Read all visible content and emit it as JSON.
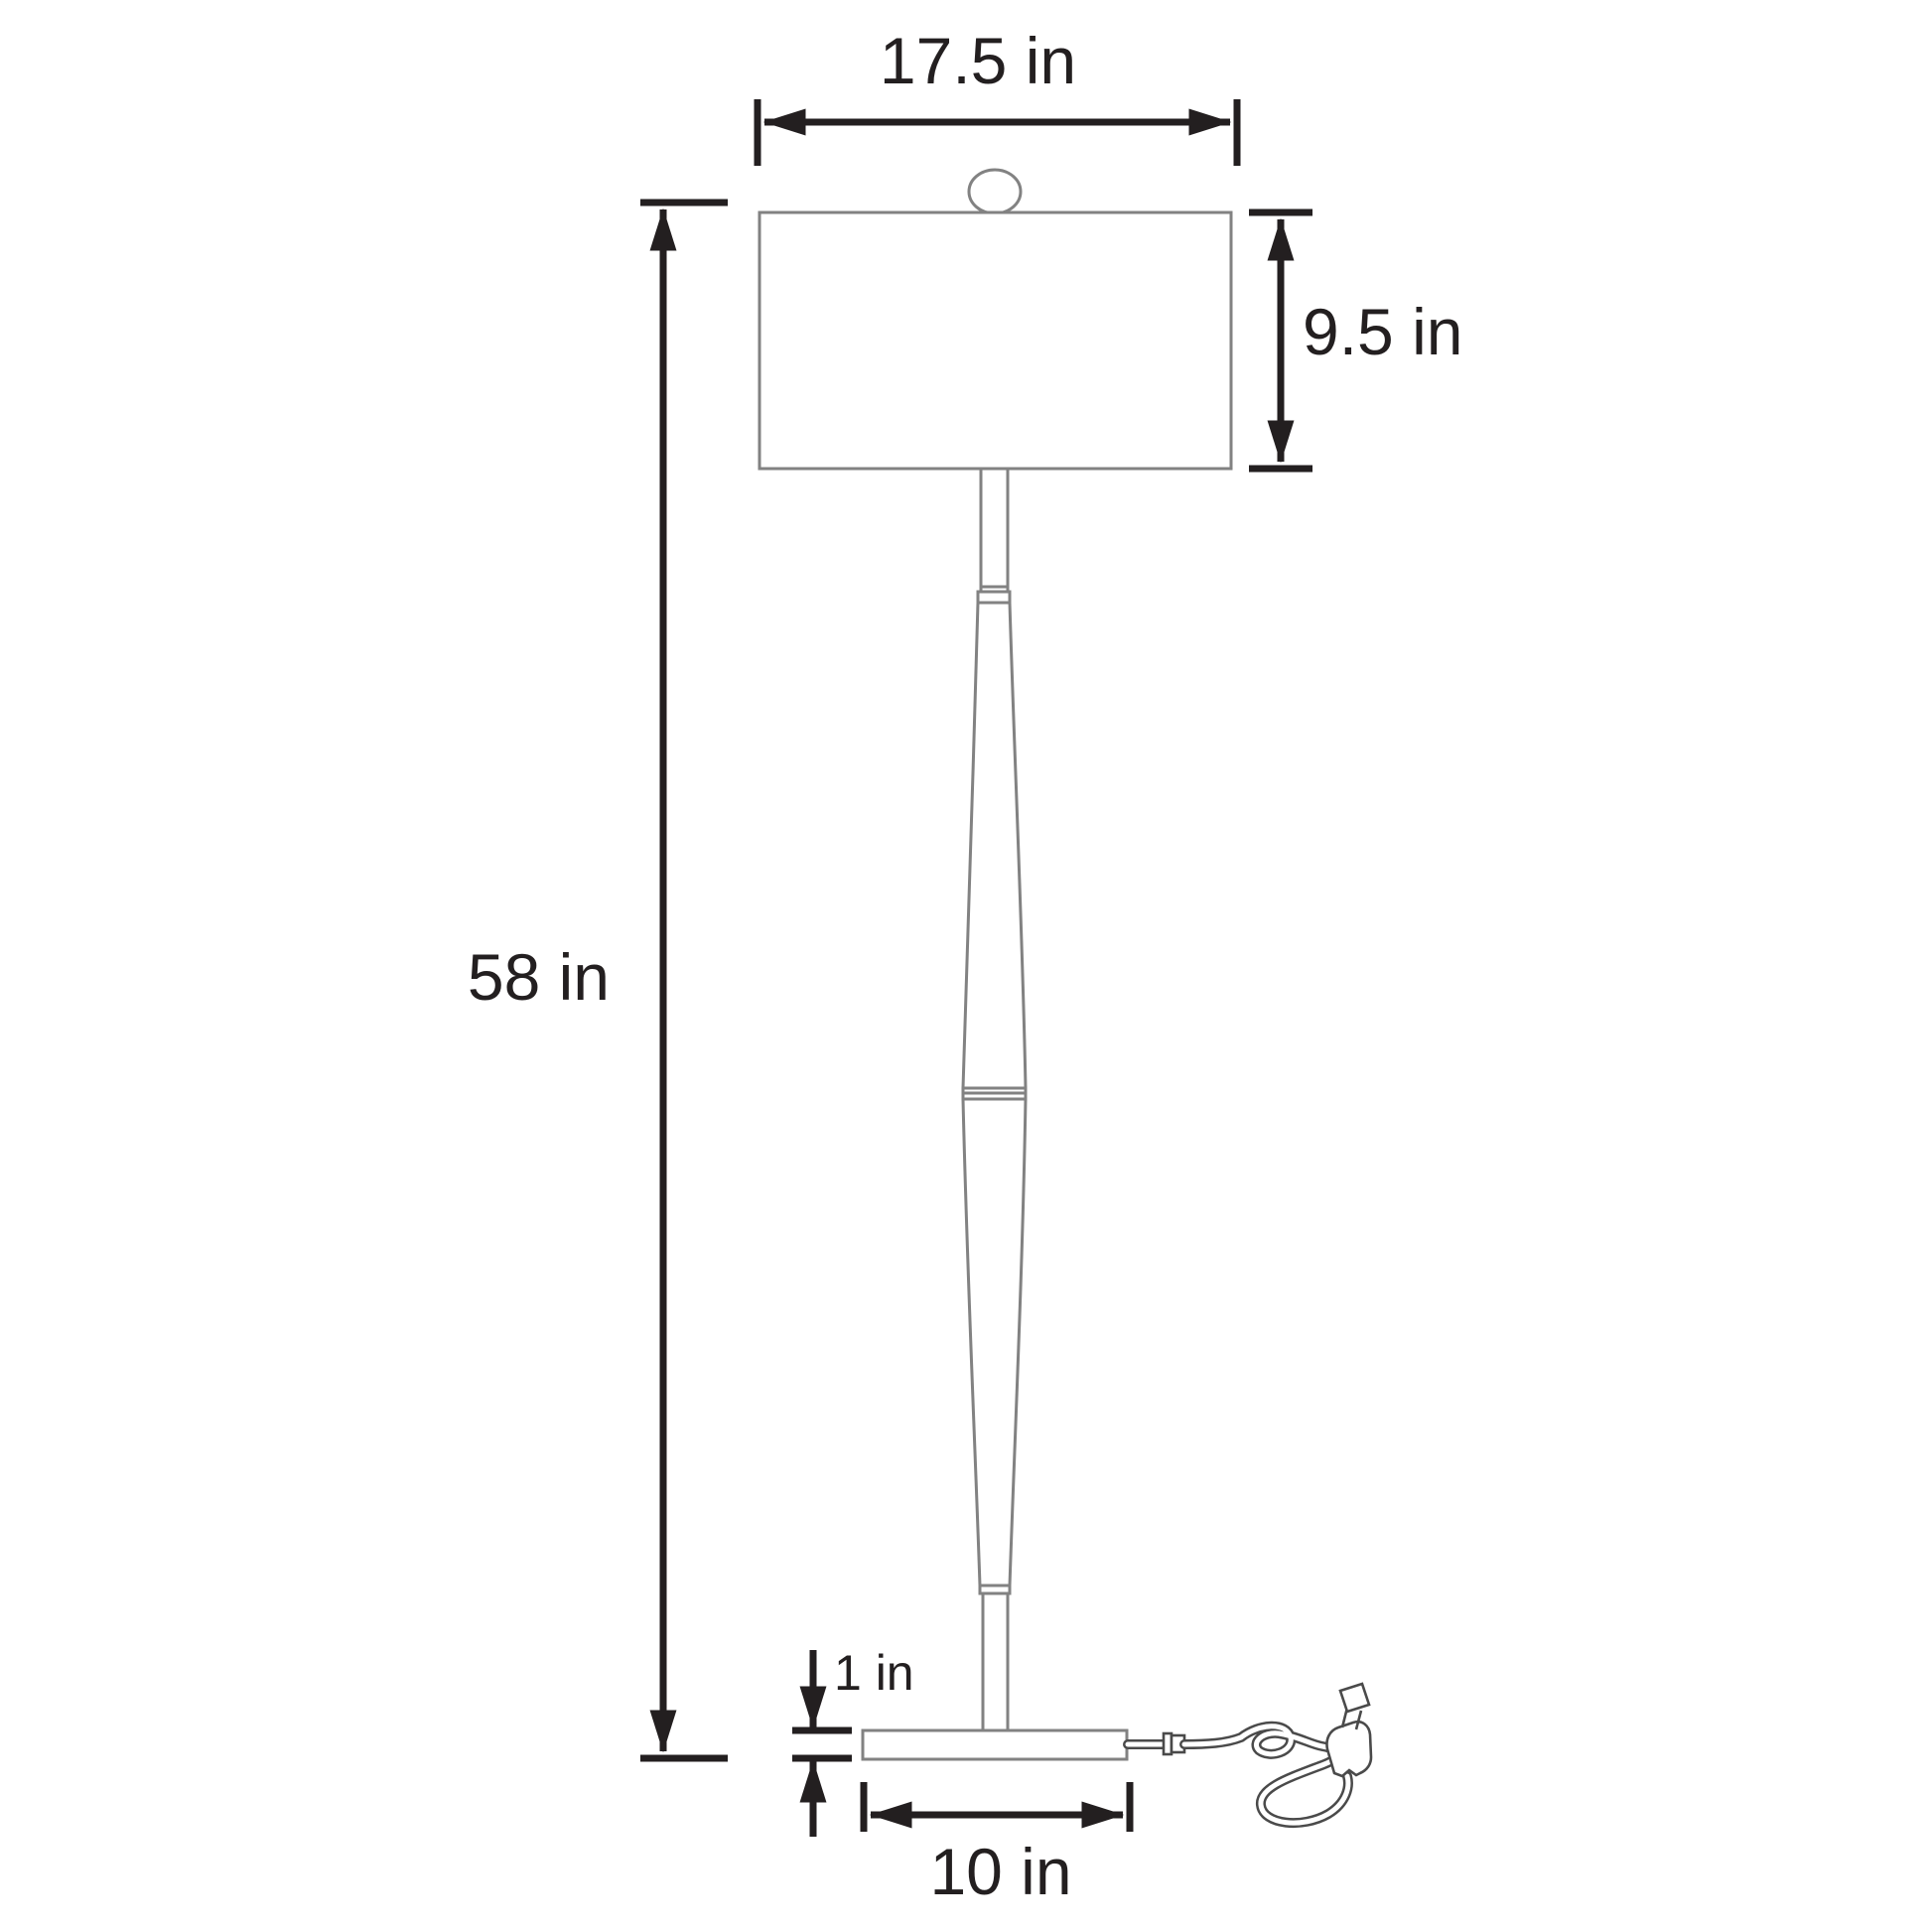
{
  "dimensions": {
    "shade_width": "17.5 in",
    "shade_height": "9.5 in",
    "total_height": "58 in",
    "base_height": "1 in",
    "base_width": "10 in"
  },
  "colors": {
    "background": "#ffffff",
    "lamp_outline": "#828282",
    "cord_outline": "#4a4a4a",
    "dimension_ink": "#231f20"
  }
}
